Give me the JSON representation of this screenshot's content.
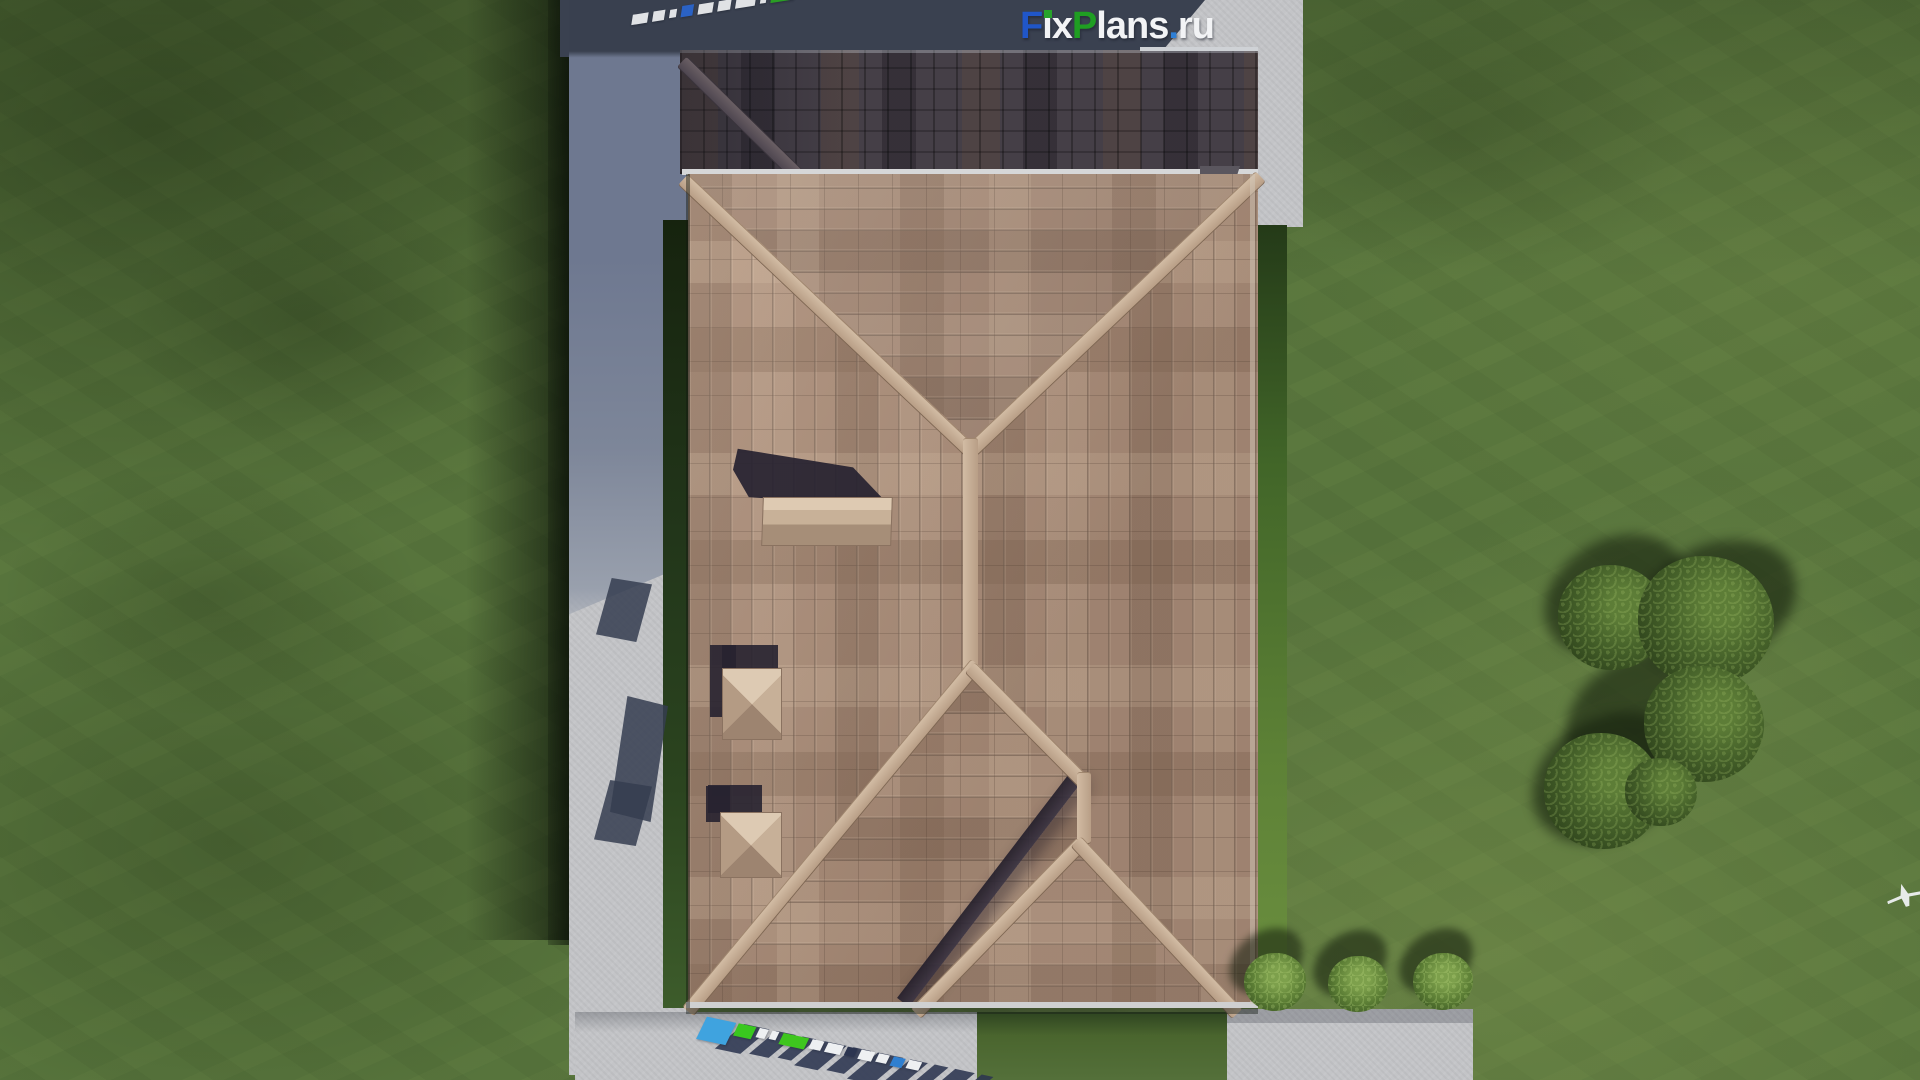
{
  "brand": {
    "site": "FixPlans.ru",
    "letters": [
      {
        "t": "F",
        "c": "#2056c8"
      },
      {
        "t": "i",
        "c": "#f2f3f5",
        "dot": "#27a32a"
      },
      {
        "t": "x",
        "c": "#f2f3f5"
      },
      {
        "t": "P",
        "c": "#1f9e22"
      },
      {
        "t": "l",
        "c": "#f2f3f5"
      },
      {
        "t": "a",
        "c": "#f2f3f5"
      },
      {
        "t": "n",
        "c": "#f2f3f5"
      },
      {
        "t": "s",
        "c": "#f2f3f5"
      },
      {
        "t": ".",
        "c": "#2e7fd6"
      },
      {
        "t": "r",
        "c": "#f2f3f5"
      },
      {
        "t": "u",
        "c": "#f2f3f5"
      }
    ]
  },
  "watermarks": {
    "top_note": "mirrored FixPlans.ru strip on shaded roof",
    "top_blocks": [
      {
        "w": 16,
        "h": 10,
        "c": "#e9ebee"
      },
      {
        "w": 12,
        "h": 10,
        "c": "#e9ebee"
      },
      {
        "w": 7,
        "h": 8,
        "c": "#e9ebee"
      },
      {
        "w": 12,
        "h": 11,
        "c": "#2a64cc"
      },
      {
        "w": 15,
        "h": 10,
        "c": "#e9ebee"
      },
      {
        "w": 13,
        "h": 10,
        "c": "#e9ebee"
      },
      {
        "w": 20,
        "h": 10,
        "c": "#e9ebee"
      },
      {
        "w": 6,
        "h": 8,
        "c": "#e9ebee"
      },
      {
        "w": 24,
        "h": 11,
        "c": "#2aa223"
      },
      {
        "w": 8,
        "h": 9,
        "c": "#e9ebee"
      },
      {
        "w": 12,
        "h": 10,
        "c": "#e9ebee"
      },
      {
        "w": 8,
        "h": 9,
        "c": "#2aa223"
      },
      {
        "w": 13,
        "h": 11,
        "c": "#2a64cc"
      },
      {
        "w": 6,
        "h": 8,
        "c": "#e9ebee"
      }
    ],
    "bottom_shadow_blocks": [
      {
        "w": 26,
        "h": 30,
        "c": "#2c3550"
      },
      {
        "w": 20,
        "h": 28,
        "c": "#2c3550"
      },
      {
        "w": 14,
        "h": 26,
        "c": "#2c3550"
      },
      {
        "w": 24,
        "h": 30,
        "c": "#2c3550"
      },
      {
        "w": 18,
        "h": 28,
        "c": "#2c3550"
      },
      {
        "w": 26,
        "h": 32,
        "c": "#2c3550"
      },
      {
        "w": 18,
        "h": 30,
        "c": "#2c3550"
      },
      {
        "w": 14,
        "h": 28,
        "c": "#2c3550"
      },
      {
        "w": 20,
        "h": 30,
        "c": "#2c3550"
      },
      {
        "w": 12,
        "h": 26,
        "c": "#2c3550"
      }
    ],
    "bottom_color_blocks": [
      {
        "w": 30,
        "h": 24,
        "c": "#3fa3df"
      },
      {
        "w": 18,
        "h": 13,
        "c": "#39c81f"
      },
      {
        "w": 9,
        "h": 10,
        "c": "#eef0f2"
      },
      {
        "w": 7,
        "h": 9,
        "c": "#eef0f2"
      },
      {
        "w": 26,
        "h": 12,
        "c": "#3ec61e"
      },
      {
        "w": 12,
        "h": 10,
        "c": "#eef0f2"
      },
      {
        "w": 16,
        "h": 10,
        "c": "#eef0f2"
      },
      {
        "w": 10,
        "h": 9,
        "c": "#2c3550"
      },
      {
        "w": 14,
        "h": 10,
        "c": "#eef0f2"
      },
      {
        "w": 11,
        "h": 9,
        "c": "#eef0f2"
      },
      {
        "w": 12,
        "h": 10,
        "c": "#2f7fd0"
      },
      {
        "w": 13,
        "h": 9,
        "c": "#eef0f2"
      }
    ]
  },
  "palette": {
    "grass": "#57743c",
    "grass_bright": "#6f8d4a",
    "grass_dark": "#3c5526",
    "concrete": "#c6c7c9",
    "concrete_shadow": "#78829a",
    "shadow_navy": "#3a4150",
    "roof_tan": "#ac8f7b",
    "roof_dark": "#453f47",
    "ridge_tan": "#c9b39d",
    "foliage": "#3c5724",
    "logo_blue": "#2056c8",
    "logo_green": "#1f9e22"
  },
  "scene_objects": [
    "lawn",
    "concrete-walkway-west",
    "concrete-pad-south",
    "concrete-pad-southeast",
    "concrete-pad-northeast",
    "house-hip-roof",
    "shaded-roof-wing",
    "roof-ridges",
    "chimney-long",
    "chimney-vent-1",
    "chimney-vent-2",
    "tree-cluster",
    "garden-bushes",
    "airplane-marker",
    "fixplans-logo",
    "fixplans-watermark-top",
    "fixplans-watermark-bottom"
  ]
}
